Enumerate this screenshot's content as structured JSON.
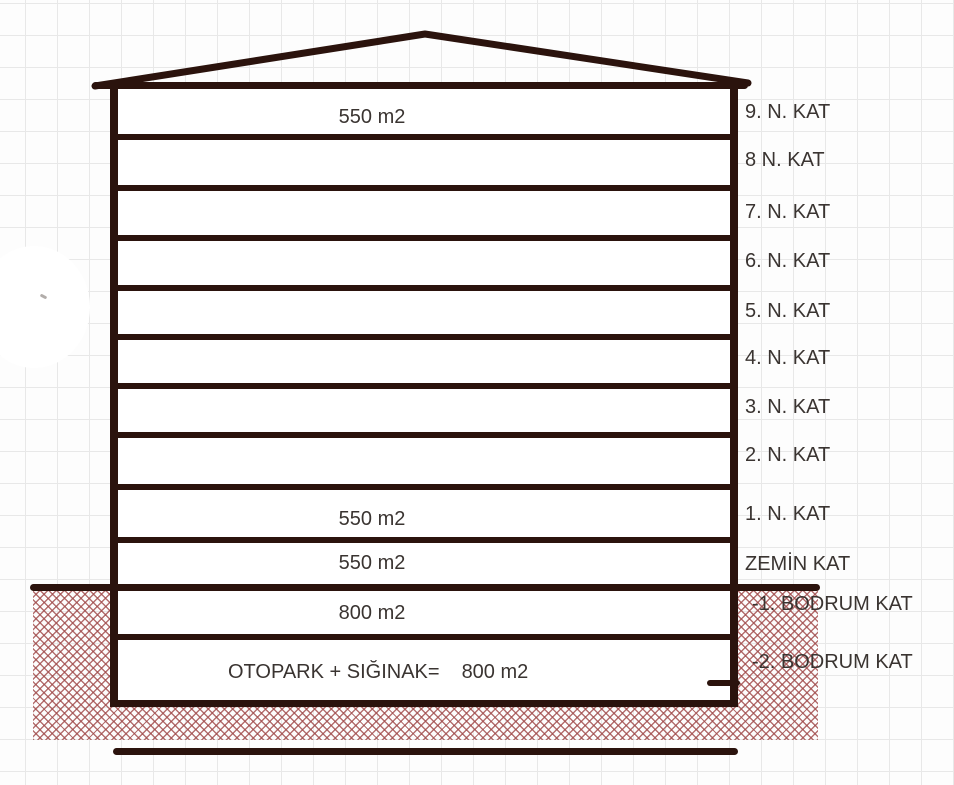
{
  "meta": {
    "description": "Hand-drawn building cross-section sketch on grid paper showing floor areas"
  },
  "colors": {
    "ink": "#2b130d",
    "text": "#3a3431",
    "hatch": "#a14c4c",
    "grid": "#e8e8e8",
    "paper": "#fdfdfd"
  },
  "building": {
    "floors": [
      {
        "label": "9. N. KAT",
        "area": "550 m2"
      },
      {
        "label": "8 N. KAT"
      },
      {
        "label": "7. N. KAT"
      },
      {
        "label": "6. N. KAT"
      },
      {
        "label": "5. N. KAT"
      },
      {
        "label": "4. N. KAT"
      },
      {
        "label": "3. N. KAT"
      },
      {
        "label": "2. N. KAT"
      },
      {
        "label": "1. N. KAT",
        "area": "550 m2"
      },
      {
        "label": "ZEMİN KAT",
        "area": "550 m2"
      },
      {
        "label": "-1. BODRUM KAT",
        "area": "800 m2"
      },
      {
        "label": "-2. BODRUM KAT",
        "area_prefix": "OTOPARK + SIĞINAK=",
        "area": "800 m2"
      }
    ]
  }
}
